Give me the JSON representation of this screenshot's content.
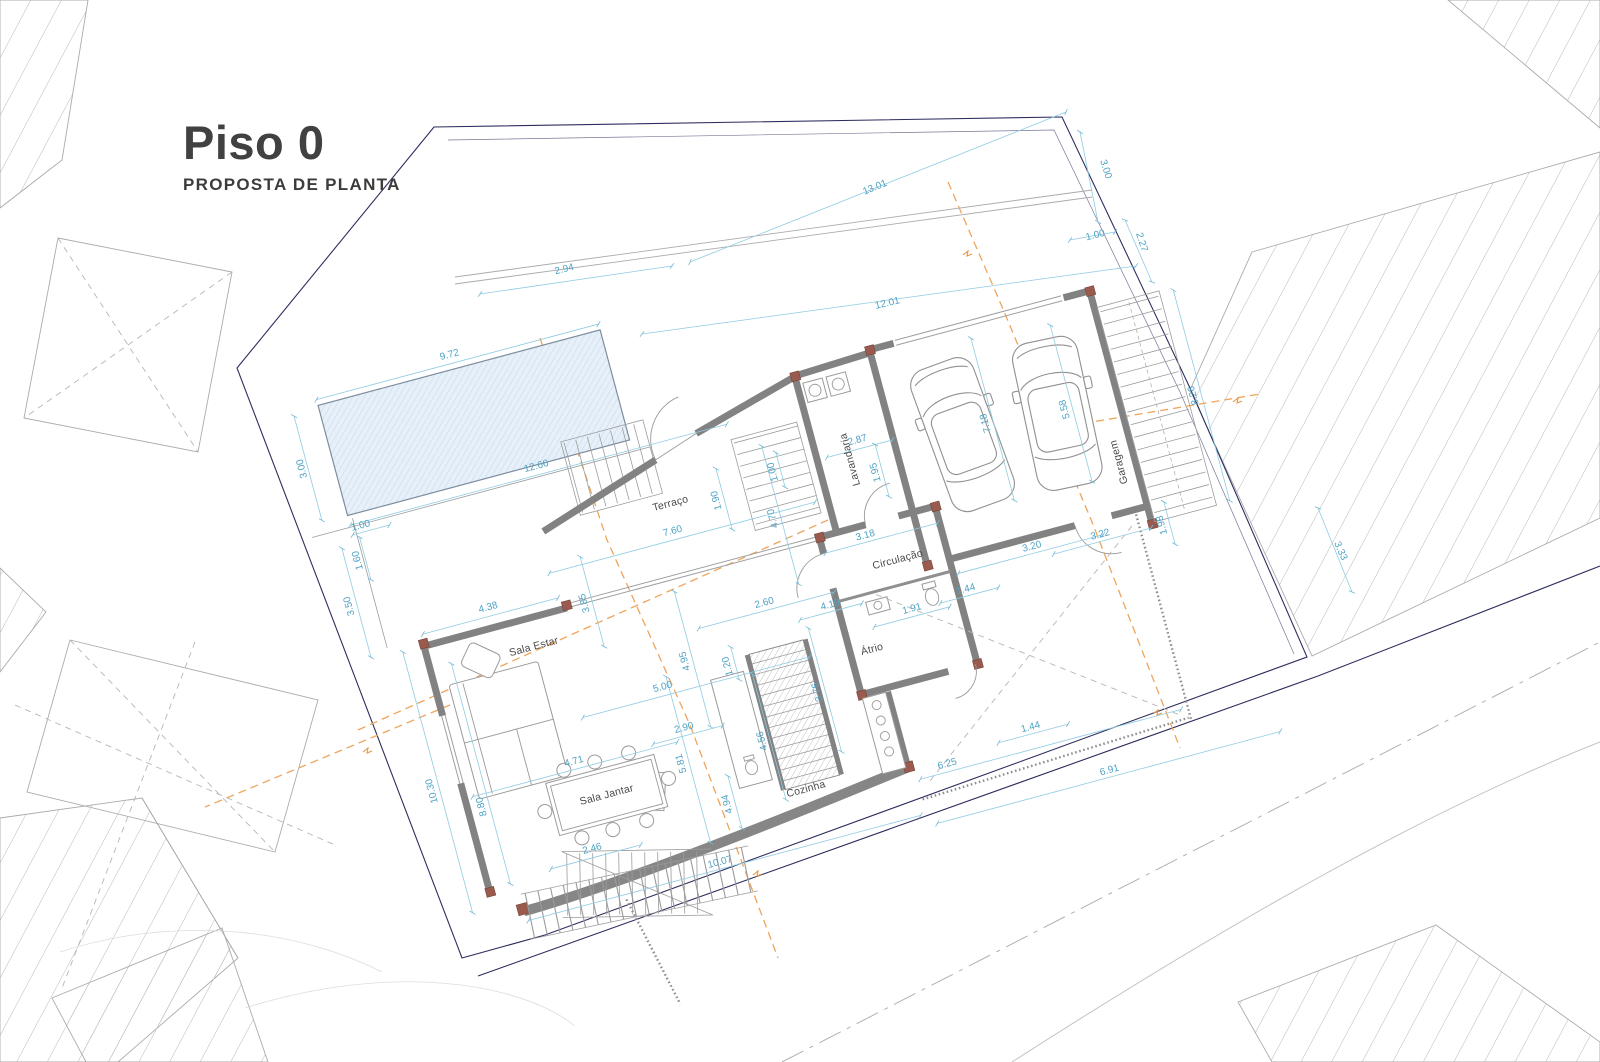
{
  "title": {
    "heading": "Piso 0",
    "subheading": "PROPOSTA DE PLANTA"
  },
  "rooms": {
    "living": "Sala Estar",
    "dining": "Sala Jantar",
    "kitchen": "Cozinha",
    "terrace": "Terraço",
    "hall": "Circulação",
    "atrium": "Átrio",
    "laundry": "Lavandaria",
    "garage": "Garagem"
  },
  "dims": {
    "lot_left_top": "2.94",
    "lot_top": "13.01",
    "lot_right_top": "3.00",
    "lot_right_gap": "1.00",
    "lot_right_side": "2.27",
    "upper_wall": "12.01",
    "pool_len": "9.72",
    "pool_width_side": "3.00",
    "deck_len": "12.66",
    "pool_offset": "1.00",
    "left_mid": "3.50",
    "left_small": "1.60",
    "terrace_len": "7.60",
    "terrace_depth": "4.70",
    "terrace_part": "2.60",
    "living_front": "5.00",
    "living_side": "3.85",
    "living_len": "4.38",
    "living_depth": "4.95",
    "entry_len": "2.87",
    "entry_depth": "1.95",
    "stair_width": "1.90",
    "stair_run": "1.00",
    "hall_len": "3.18",
    "hall_ext": "3.20",
    "hall_small": "1.44",
    "wc_len": "1.91",
    "garage_depth": "7.18",
    "garage_len": "5.58",
    "side_stair": "8.26",
    "garage_rear": "3.22",
    "garage_side_gap": "1.98",
    "boundary_side": "3.33",
    "dining_len": "4.71",
    "dining_depth": "5.81",
    "kitchen_depth": "3.76",
    "kitchen_small": "1.20",
    "kitchen_run": "4.56",
    "kitchen_top": "4.19",
    "kitchen_gap": "2.90",
    "low_stair": "2.46",
    "pergola_depth": "4.94",
    "south_len": "10.07",
    "patio_len": "6.25",
    "patio_small": "1.44",
    "south_out": "6.91",
    "west_len": "10.30",
    "west_inner": "8.80"
  },
  "colors": {
    "dimension": "#5FAECB",
    "setback": "#EFA45B",
    "wall": "#828282",
    "boundary": "#2E2E5F",
    "pool_fill": "#E4EEF8"
  }
}
